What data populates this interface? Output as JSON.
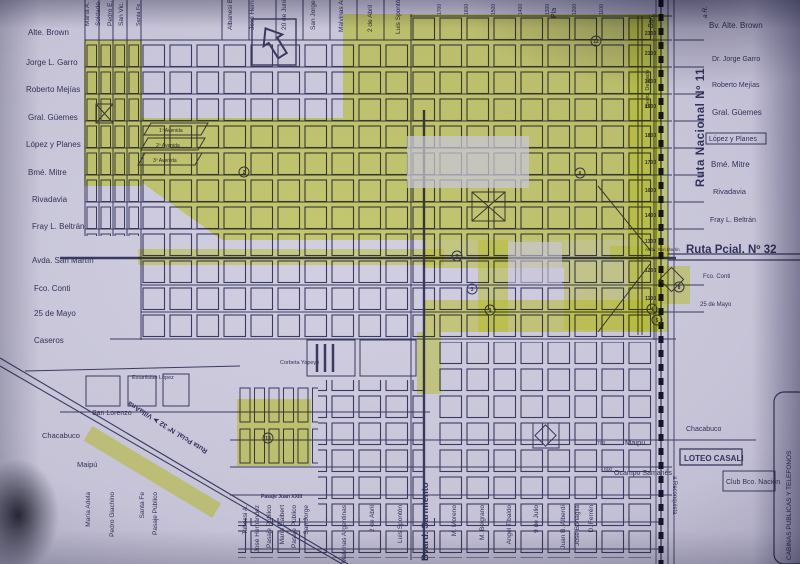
{
  "labels": {
    "left": [
      "Alte. Brown",
      "Jorge L. Garro",
      "Roberto Mejías",
      "Gral. Güemes",
      "López y Planes",
      "Bmé. Mitre",
      "Rivadavia",
      "Fray L. Beltrán",
      "Avda. San Martín",
      "Fco. Conti",
      "25 de Mayo",
      "Caseros"
    ],
    "left_lower": [
      "Estanislao López",
      "San Lorenzo",
      "Chacabuco",
      "Maipú"
    ],
    "right": [
      "Bv. Alte. Brown",
      "Dr. Jorge Garro",
      "Roberto Mejías",
      "Gral. Güemes",
      "López y Planes",
      "Bmé. Mitre",
      "Rivadavia",
      "Fray L. Beltrán",
      "Ruta Pcial. Nº 32",
      "Fco. Conti",
      "25 de Mayo"
    ],
    "right_lower": [
      "Chacabuco",
      "Maipú",
      "Ocampo Samanés",
      "LOTEO CASALI",
      "Club Bco. Nación",
      "CABINAS PUBLICAS Y TELEFONOS"
    ],
    "top_vertical": [
      "María A.",
      "Soldado",
      "Pedro E.",
      "San Vic.",
      "Santa Fe",
      "Albanesi B.",
      "José Hernández",
      "20 de Junio",
      "San Jorge",
      "Malvinas Arg.",
      "2 de Abril",
      "Luis Spontón",
      "Pla",
      "Barr.",
      "a R."
    ],
    "bottom_left_vertical": [
      "María Adela",
      "Pedro Giachino",
      "Santa Fe",
      "Pasaje Público"
    ],
    "bottom_vertical": [
      "Tabossi A.",
      "José Hernández",
      "Pasaje Público",
      "Mario Galbert",
      "Pasaje Público",
      "San Jorge",
      "Malvinas Argentinas",
      "2 de Abril",
      "Luis Spontón",
      "Bvard. Sarmiento",
      "M. Moreno",
      "M. Belgrano",
      "Angel Tibaldo",
      "9 de Julio",
      "Juan B. Alberdi",
      "José Bonaglia",
      "D. Ferrén"
    ],
    "avenidas": [
      "1º Avenida",
      "2º Avenida",
      "3º Avenida"
    ],
    "map_small": [
      "Pasaje Juan XXIII",
      "Corbeta Yapeyó"
    ],
    "routes": {
      "ruta11": "Ruta Nacional Nº 11",
      "ruta32_villa_ana": "Ruta Pcial. Nº 32  ➤  VillaAna",
      "bvard_delgado": "Bvard. Delgado",
      "a_reconquista": "a Reconquista",
      "avda_san_martin": "Avda. San Martín"
    },
    "km_rail": [
      "2300",
      "2100",
      "2000",
      "1900",
      "1800",
      "1700",
      "1600",
      "1400",
      "1300",
      "1200",
      "1100"
    ],
    "km_top": [
      "1700",
      "1600",
      "1500",
      "1400",
      "1300",
      "1200",
      "1100"
    ],
    "km_bottom": [
      "700",
      "800"
    ],
    "markers": [
      "2",
      "7",
      "3",
      "9",
      "6",
      "12",
      "13",
      "4",
      "5",
      "8"
    ]
  },
  "colors": {
    "paper": "#c7c4d8",
    "ink": "#3a3a60",
    "highlight": "#e4ef2e",
    "route11_text": "#6d2f44",
    "railway": "#15152e"
  }
}
